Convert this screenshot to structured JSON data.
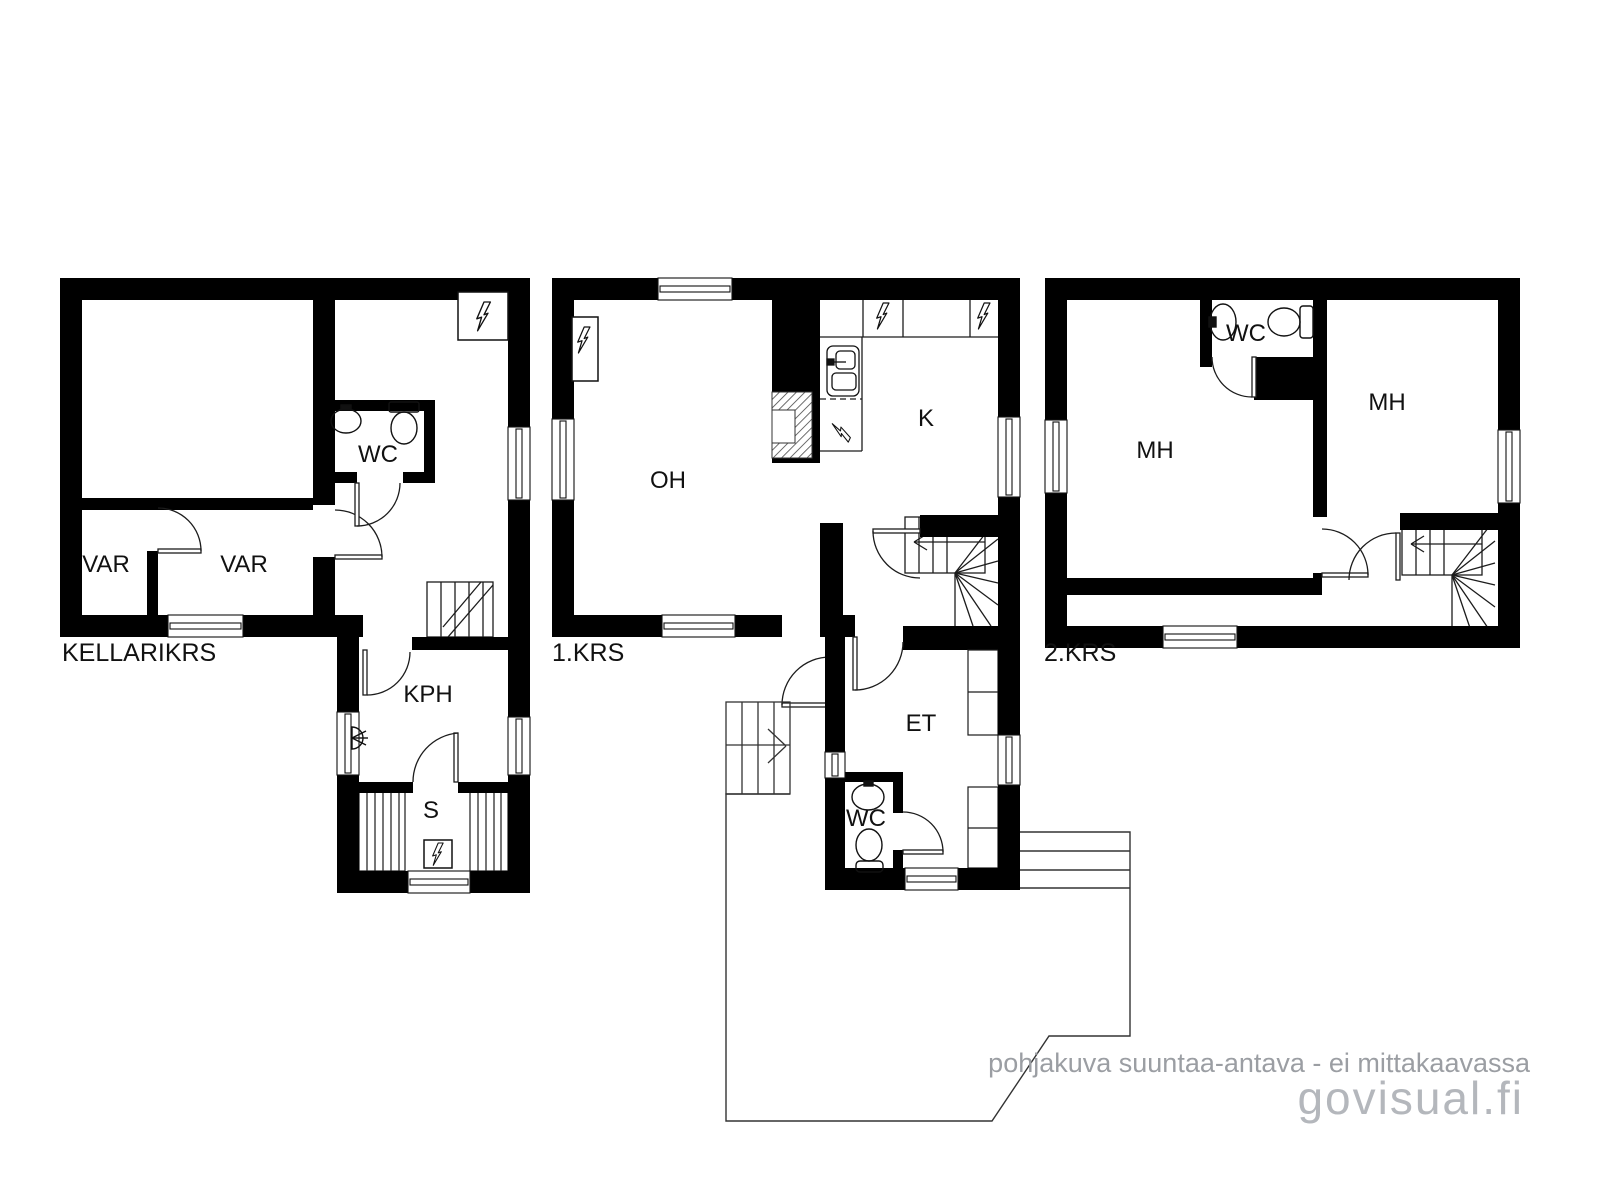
{
  "plans": {
    "basement": {
      "label": "KELLARIKRS",
      "rooms": {
        "var_left": "VAR",
        "var_right": "VAR",
        "wc": "WC",
        "kph": "KPH",
        "sauna": "S"
      }
    },
    "floor1": {
      "label": "1.KRS",
      "rooms": {
        "oh": "OH",
        "kitchen": "K",
        "et": "ET",
        "wc": "WC"
      }
    },
    "floor2": {
      "label": "2.KRS",
      "rooms": {
        "mh_left": "MH",
        "mh_right": "MH",
        "wc": "WC"
      }
    }
  },
  "footer": {
    "disclaimer": "pohjakuva suuntaa-antava - ei mittakaavassa",
    "watermark": "govisual.fi"
  },
  "icons": {
    "lightning": "electrical-appliance / panel symbol",
    "shower": "shower-head symbol",
    "sink": "washbasin symbol",
    "toilet": "toilet symbol",
    "stairs": "winder-staircase symbol"
  },
  "colors": {
    "wall": "#000000",
    "line": "#1c1c1c",
    "disclaimer_text": "#9b9ea3",
    "watermark_text": "#b4b7bc",
    "background": "#ffffff"
  }
}
